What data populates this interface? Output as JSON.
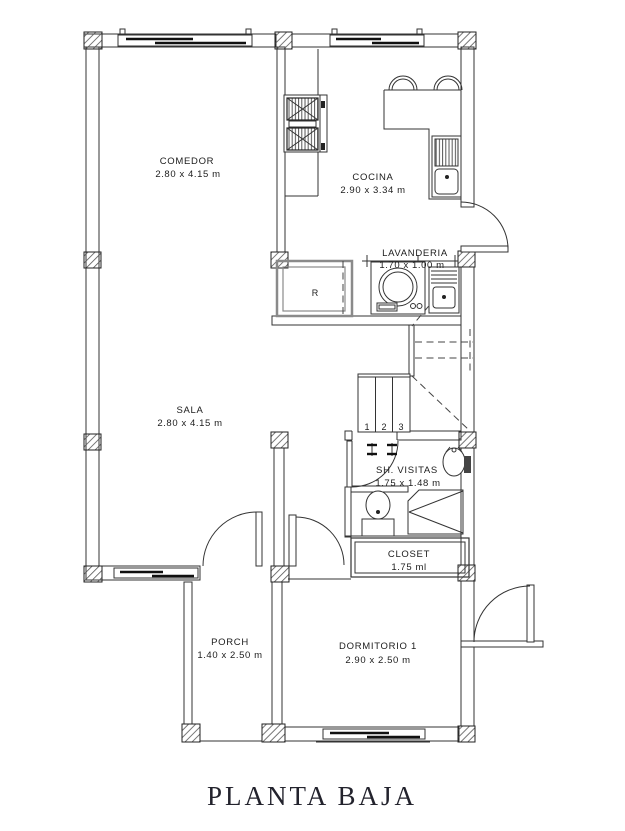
{
  "title": "PLANTA BAJA",
  "rooms": {
    "comedor": {
      "name": "COMEDOR",
      "dims": "2.80 x 4.15 m"
    },
    "cocina": {
      "name": "COCINA",
      "dims": "2.90 x 3.34 m"
    },
    "lavanderia": {
      "name": "LAVANDERIA",
      "dims": "1.70 x 1.00 m"
    },
    "sala": {
      "name": "SALA",
      "dims": "2.80 x 4.15 m"
    },
    "sh_visitas": {
      "name": "SH. VISITAS",
      "dims": "1.75 x 1.48 m"
    },
    "closet": {
      "name": "CLOSET",
      "dims": "1.75 ml"
    },
    "porch": {
      "name": "PORCH",
      "dims": "1.40 x 2.50 m"
    },
    "dormitorio1": {
      "name": "DORMITORIO 1",
      "dims": "2.90 x 2.50 m"
    }
  },
  "stairs": {
    "steps": [
      "1",
      "2",
      "3"
    ]
  },
  "fixtures": {
    "refrigerator_label": "R"
  },
  "colors": {
    "line": "#333333",
    "background": "#ffffff"
  }
}
